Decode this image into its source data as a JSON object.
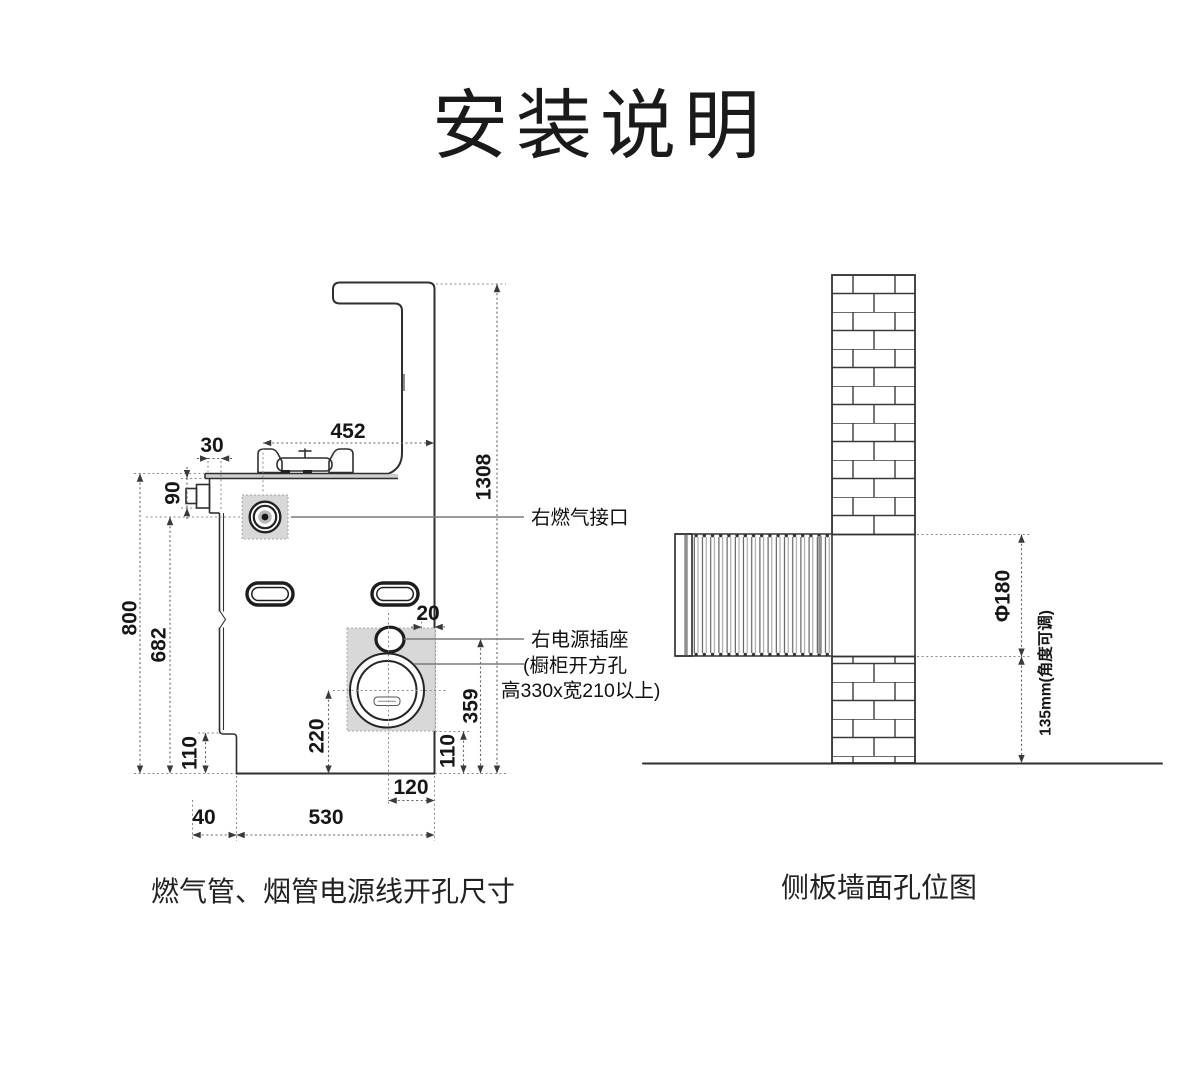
{
  "title": "安装说明",
  "colors": {
    "background": "#ffffff",
    "line": "#2f2f2f",
    "dimension_line": "#5f5f5f",
    "zone_fill": "#d8d8d8",
    "text": "#161616"
  },
  "left_diagram": {
    "caption": "燃气管、烟管电源线开孔尺寸",
    "dims": {
      "burner_to_back": "452",
      "top_overhang": "30",
      "inlet_height": "90",
      "body_height": "800",
      "gas_port_to_bottom": "682",
      "step_height_left": "110",
      "duct_center_to_bottom": "220",
      "zone_bottom_to_base": "110",
      "socket_to_bottom": "359",
      "duct_center_to_back": "120",
      "base_left_offset": "40",
      "base_width": "530",
      "total_height": "1308",
      "socket_edge_gap": "20"
    },
    "labels": {
      "gas_port": "右燃气接口",
      "power_socket": "右电源插座",
      "cabinet_line1": "(橱柜开方孔",
      "cabinet_line2": "高330x宽210以上)"
    }
  },
  "right_diagram": {
    "caption": "侧板墙面孔位图",
    "dims": {
      "hole_diameter": "Φ180",
      "floor_clearance": "135mm(角度可调)"
    }
  }
}
